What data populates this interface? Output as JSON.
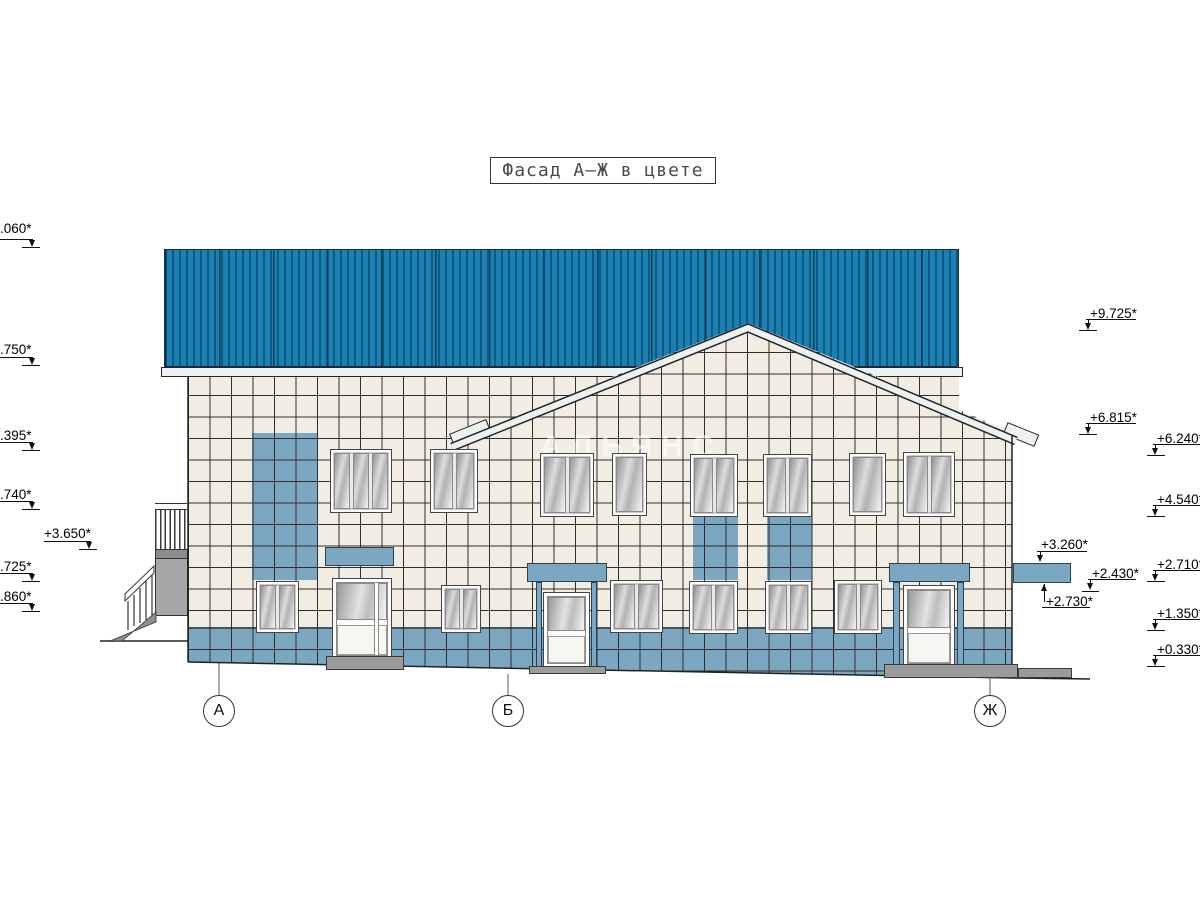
{
  "title": "Фасад А–Ж в цвете",
  "watermark": "АЛЬЯНС",
  "colors": {
    "roof_blue": "#1a81b2",
    "roof_dark_stripe": "#0c5a84",
    "tile_cream": "#f2ede2",
    "tile_blue": "#7ba7c3",
    "grid_line": "#2f2f2f",
    "eave_white": "#edf2ec",
    "concrete_gray": "#9b9b9b"
  },
  "axes": [
    {
      "label": "А",
      "x": 219,
      "line_y1": 663,
      "line_y2": 695,
      "circle_cy": 711
    },
    {
      "label": "Б",
      "x": 508,
      "line_y1": 674,
      "line_y2": 695,
      "circle_cy": 711
    },
    {
      "label": "Ж",
      "x": 990,
      "line_y1": 678,
      "line_y2": 695,
      "circle_cy": 711
    }
  ],
  "levels": [
    {
      "label": ".060*",
      "tx": 0,
      "ty": 221,
      "lx1": 0,
      "lx2": 33,
      "ly": 239,
      "dx": 32,
      "tipy": 247,
      "dir": "down",
      "tick": [
        22,
        40,
        247
      ]
    },
    {
      "label": ".750*",
      "tx": 0,
      "ty": 342,
      "lx1": 0,
      "lx2": 33,
      "ly": 357,
      "dx": 32,
      "tipy": 365,
      "dir": "down",
      "tick": [
        22,
        40,
        365
      ]
    },
    {
      "label": ".395*",
      "tx": 0,
      "ty": 428,
      "lx1": 0,
      "lx2": 33,
      "ly": 442,
      "dx": 32,
      "tipy": 450,
      "dir": "down",
      "tick": [
        22,
        40,
        450
      ]
    },
    {
      "label": ".740*",
      "tx": 0,
      "ty": 487,
      "lx1": 0,
      "lx2": 33,
      "ly": 501,
      "dx": 32,
      "tipy": 509,
      "dir": "down",
      "tick": [
        22,
        40,
        509
      ]
    },
    {
      "label": "+3.650*",
      "tx": 44,
      "ty": 526,
      "lx1": 44,
      "lx2": 91,
      "ly": 541,
      "dx": 89,
      "tipy": 549,
      "dir": "down",
      "tick": [
        79,
        97,
        549
      ]
    },
    {
      "label": ".725*",
      "tx": 0,
      "ty": 559,
      "lx1": 0,
      "lx2": 33,
      "ly": 573,
      "dx": 32,
      "tipy": 581,
      "dir": "down",
      "tick": [
        22,
        40,
        581
      ]
    },
    {
      "label": ".860*",
      "tx": 0,
      "ty": 589,
      "lx1": 0,
      "lx2": 33,
      "ly": 603,
      "dx": 32,
      "tipy": 611,
      "dir": "down",
      "tick": [
        22,
        40,
        611
      ]
    },
    {
      "label": "+9.725*",
      "tx": 1090,
      "ty": 306,
      "lx1": 1086,
      "lx2": 1136,
      "ly": 319,
      "dx": 1088,
      "tipy": 330,
      "dir": "down",
      "tick": [
        1079,
        1097,
        330
      ]
    },
    {
      "label": "+6.815*",
      "tx": 1090,
      "ty": 410,
      "lx1": 1086,
      "lx2": 1136,
      "ly": 423,
      "dx": 1088,
      "tipy": 434,
      "dir": "down",
      "tick": [
        1079,
        1097,
        434
      ]
    },
    {
      "label": "+6.240*",
      "tx": 1157,
      "ty": 431,
      "lx1": 1153,
      "lx2": 1200,
      "ly": 444,
      "dx": 1155,
      "tipy": 455,
      "dir": "down",
      "tick": [
        1147,
        1165,
        455
      ]
    },
    {
      "label": "+4.540*",
      "tx": 1157,
      "ty": 492,
      "lx1": 1153,
      "lx2": 1200,
      "ly": 505,
      "dx": 1155,
      "tipy": 516,
      "dir": "down",
      "tick": [
        1147,
        1165,
        516
      ]
    },
    {
      "label": "+2.710*",
      "tx": 1157,
      "ty": 557,
      "lx1": 1153,
      "lx2": 1200,
      "ly": 570,
      "dx": 1155,
      "tipy": 581,
      "dir": "down",
      "tick": [
        1147,
        1165,
        581
      ]
    },
    {
      "label": "+1.350*",
      "tx": 1157,
      "ty": 606,
      "lx1": 1153,
      "lx2": 1200,
      "ly": 619,
      "dx": 1155,
      "tipy": 630,
      "dir": "down",
      "tick": [
        1147,
        1165,
        630
      ]
    },
    {
      "label": "+0.330*",
      "tx": 1157,
      "ty": 642,
      "lx1": 1153,
      "lx2": 1200,
      "ly": 655,
      "dx": 1155,
      "tipy": 666,
      "dir": "down",
      "tick": [
        1147,
        1165,
        666
      ]
    },
    {
      "label": "+3.260*",
      "tx": 1041,
      "ty": 537,
      "lx1": 1037,
      "lx2": 1087,
      "ly": 551,
      "dx": 1040,
      "tipy": 562,
      "dir": "down",
      "tick": null
    },
    {
      "label": "+2.430*",
      "tx": 1092,
      "ty": 566,
      "lx1": 1088,
      "lx2": 1136,
      "ly": 579,
      "dx": 1090,
      "tipy": 590,
      "dir": "down",
      "tick": [
        1082,
        1099,
        591
      ]
    },
    {
      "label": "+2.730*",
      "tx": 1046,
      "ty": 594,
      "lx1": 1042,
      "lx2": 1090,
      "ly": 607,
      "dx": 1044,
      "tipy": 584,
      "dir": "up",
      "tick": null
    }
  ],
  "windows_upper": [
    {
      "x": 330,
      "y": 449,
      "w": 62,
      "h": 64,
      "panes": 3
    },
    {
      "x": 430,
      "y": 449,
      "w": 48,
      "h": 64,
      "panes": 2
    },
    {
      "x": 540,
      "y": 453,
      "w": 54,
      "h": 64,
      "panes": 2
    },
    {
      "x": 612,
      "y": 453,
      "w": 35,
      "h": 63,
      "panes": 1
    },
    {
      "x": 690,
      "y": 454,
      "w": 48,
      "h": 63,
      "panes": 2
    },
    {
      "x": 763,
      "y": 454,
      "w": 49,
      "h": 63,
      "panes": 2
    },
    {
      "x": 849,
      "y": 453,
      "w": 37,
      "h": 63,
      "panes": 1
    },
    {
      "x": 903,
      "y": 452,
      "w": 52,
      "h": 65,
      "panes": 2
    }
  ],
  "windows_lower": [
    {
      "x": 256,
      "y": 581,
      "w": 43,
      "h": 52,
      "panes": 2
    },
    {
      "x": 441,
      "y": 585,
      "w": 40,
      "h": 48,
      "panes": 2
    },
    {
      "x": 610,
      "y": 580,
      "w": 53,
      "h": 53,
      "panes": 2
    },
    {
      "x": 689,
      "y": 581,
      "w": 49,
      "h": 53,
      "panes": 2
    },
    {
      "x": 765,
      "y": 581,
      "w": 47,
      "h": 53,
      "panes": 2
    },
    {
      "x": 834,
      "y": 580,
      "w": 48,
      "h": 54,
      "panes": 2
    }
  ],
  "doors": [
    {
      "x": 332,
      "y": 578,
      "w": 60,
      "h": 82,
      "mullion": true
    },
    {
      "x": 543,
      "y": 592,
      "w": 47,
      "h": 76,
      "mullion": false
    },
    {
      "x": 903,
      "y": 585,
      "w": 52,
      "h": 83,
      "mullion": false
    }
  ],
  "signs": [
    {
      "x": 325,
      "y": 547,
      "w": 69,
      "h": 19
    },
    {
      "x": 527,
      "y": 563,
      "w": 80,
      "h": 19
    },
    {
      "x": 889,
      "y": 563,
      "w": 81,
      "h": 19
    },
    {
      "x": 1013,
      "y": 563,
      "w": 58,
      "h": 20
    }
  ],
  "stripes": [
    {
      "x": 252,
      "y": 433,
      "w": 65,
      "h": 147
    },
    {
      "x": 693,
      "y": 517,
      "w": 45,
      "h": 63
    },
    {
      "x": 767,
      "y": 517,
      "w": 45,
      "h": 63
    }
  ],
  "pilasters": [
    {
      "x": 536,
      "y": 582,
      "w": 6,
      "h": 86
    },
    {
      "x": 591,
      "y": 582,
      "w": 6,
      "h": 86
    },
    {
      "x": 893,
      "y": 582,
      "w": 7,
      "h": 86
    },
    {
      "x": 957,
      "y": 582,
      "w": 7,
      "h": 86
    }
  ],
  "steps": [
    {
      "x": 326,
      "y": 656,
      "w": 78,
      "h": 14
    },
    {
      "x": 529,
      "y": 666,
      "w": 77,
      "h": 8
    },
    {
      "x": 884,
      "y": 664,
      "w": 134,
      "h": 14
    },
    {
      "x": 1018,
      "y": 668,
      "w": 54,
      "h": 10
    }
  ]
}
